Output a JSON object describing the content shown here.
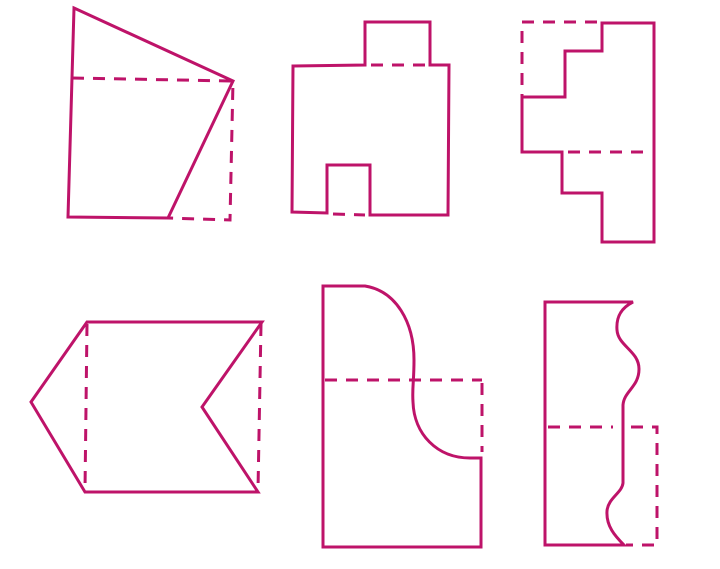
{
  "canvas": {
    "width": 720,
    "height": 569,
    "background": "#ffffff"
  },
  "style": {
    "stroke_color": "#BE1369",
    "stroke_width": 3,
    "dash_pattern": "12 9"
  },
  "figures": [
    {
      "name": "fold-figure-quadrilateral",
      "position": "top-left",
      "solid": "M 74 8 L 233 81 L 168 218 L 68 217 Z",
      "dashed": "M 72 78 L 233 81 L 230 220 L 168 218"
    },
    {
      "name": "fold-figure-square-tab-notch",
      "position": "top-center",
      "solid": "M 293 66 L 365 65 L 365 22 L 430 22 L 430 65 L 449 65 L 448 215 L 370 215 L 370 165 L 327 165 L 327 213 L 292 212 Z",
      "dashed": "M 371 65 L 428 65 M 333 214 L 365 215"
    },
    {
      "name": "fold-figure-staircase",
      "position": "top-right",
      "solid": "M 602 23 L 602 51 L 565 51 L 565 97 L 522 97 L 522 152 L 562 152 L 562 193 L 602 193 L 602 242 L 654 242 L 654 23 Z",
      "dashed": "M 597 22 L 522 22 L 522 97 M 568 152 L 649 152"
    },
    {
      "name": "fold-figure-chevron",
      "position": "bottom-left",
      "solid": "M 87 322 L 262 322 L 202 407 L 258 492 L 85 492 L 31 402 Z",
      "dashed": "M 87 324 L 85 490 M 261 324 L 258 490"
    },
    {
      "name": "fold-figure-s-curve",
      "position": "bottom-center",
      "solid": "M 323 286 L 365 286 C 396 291 414 322 414 360 C 414 382 412 388 413 402 C 414 434 437 458 470 458 L 481 458 L 481 547 L 323 547 Z",
      "dashed": "M 325 380 L 482 380 M 482 383 L 482 452"
    },
    {
      "name": "fold-figure-wavy",
      "position": "bottom-right",
      "solid": "M 545 302 L 633 302 C 621 308 616 317 617 330 C 618 346 639 351 639 369 C 639 387 624 391 623 405 L 623 483 C 622 493 608 498 607 511 C 606 526 615 536 624 545 L 545 545 Z",
      "dashed": "M 548 427 L 613 427 M 631 427 L 657 427 L 657 545 L 626 545"
    }
  ]
}
